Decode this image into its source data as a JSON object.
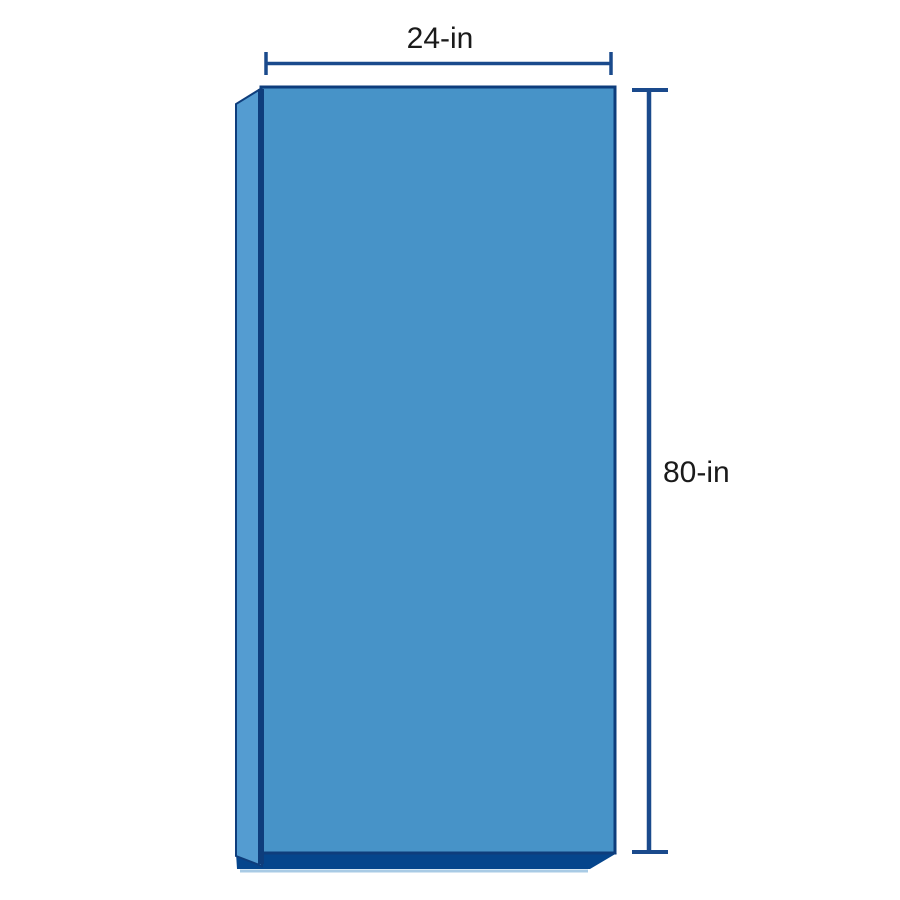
{
  "diagram": {
    "width_dimension": {
      "label": "24-in"
    },
    "height_dimension": {
      "label": "80-in"
    }
  },
  "colors": {
    "background": "#FFFFFF",
    "front_face": "#4793C8",
    "side_face": "#549CD1",
    "bottom_face": "#05458C",
    "outline": "#0E3D7C",
    "dimension_line": "#1A4A8C",
    "label_text": "#1A1A1A",
    "reflection": "#A9CBE5"
  }
}
